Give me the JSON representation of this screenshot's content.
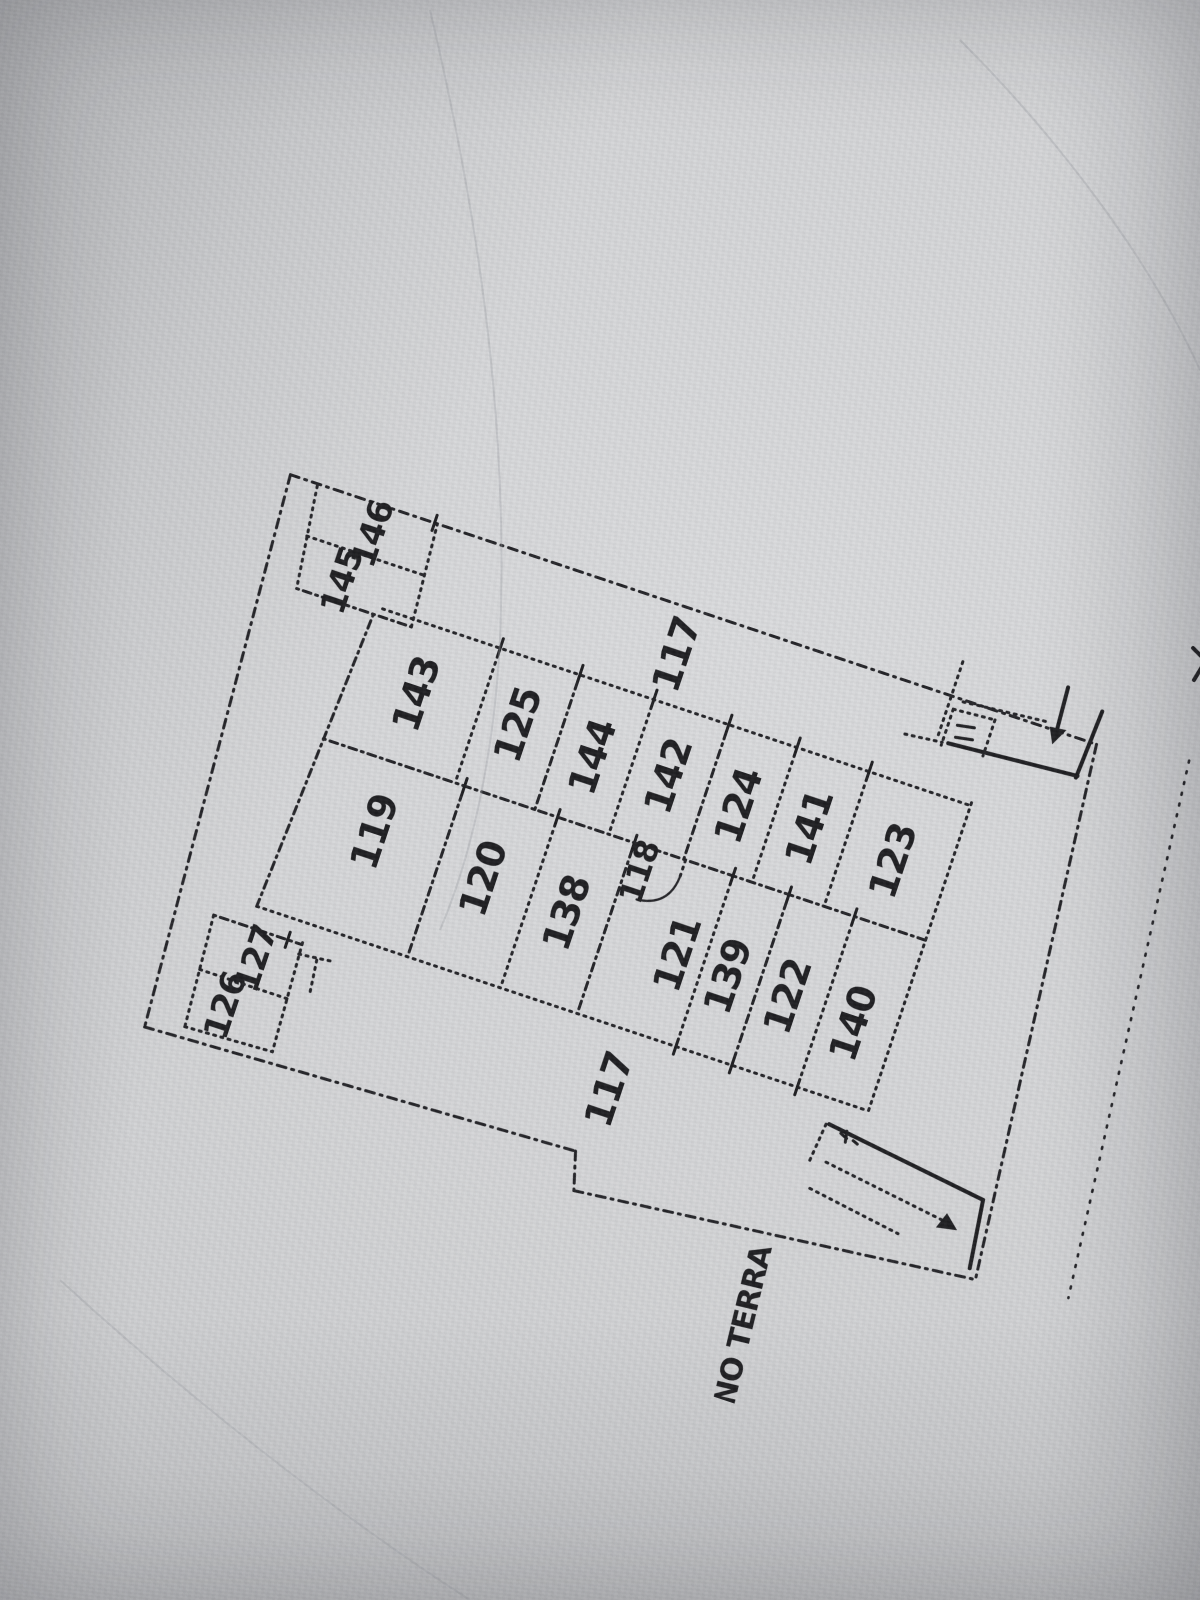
{
  "document": {
    "type": "cadastral floor plan photo",
    "title": "PIANO TERRA",
    "ink_color": "#1d1d20",
    "paper_color": "#d4d5d7"
  },
  "plan": {
    "title_label": "PIANO TERRA",
    "room_numbers": [
      "117",
      "118",
      "119",
      "120",
      "121",
      "122",
      "123",
      "124",
      "125",
      "126",
      "127",
      "138",
      "139",
      "140",
      "141",
      "142",
      "143",
      "144",
      "145",
      "146"
    ],
    "labels": [
      {
        "id": "room-146",
        "label": "146",
        "x": -8,
        "y": 30,
        "size": 34
      },
      {
        "id": "room-145",
        "label": "145",
        "x": -22,
        "y": 84,
        "size": 34
      },
      {
        "id": "corridor-117-top",
        "label": "117",
        "x": 318,
        "y": 48
      },
      {
        "id": "room-143",
        "label": "143",
        "x": 84,
        "y": 168
      },
      {
        "id": "room-125",
        "label": "125",
        "x": 190,
        "y": 165
      },
      {
        "id": "room-144",
        "label": "144",
        "x": 271,
        "y": 172
      },
      {
        "id": "room-142",
        "label": "142",
        "x": 349,
        "y": 166
      },
      {
        "id": "room-124",
        "label": "124",
        "x": 425,
        "y": 172
      },
      {
        "id": "room-141",
        "label": "141",
        "x": 499,
        "y": 170
      },
      {
        "id": "room-123",
        "label": "123",
        "x": 589,
        "y": 175
      },
      {
        "id": "room-119",
        "label": "119",
        "x": 88,
        "y": 312
      },
      {
        "id": "room-120",
        "label": "120",
        "x": 206,
        "y": 322
      },
      {
        "id": "room-138",
        "label": "138",
        "x": 296,
        "y": 328
      },
      {
        "id": "room-118",
        "label": "118",
        "x": 352,
        "y": 266,
        "size": 32
      },
      {
        "id": "room-121",
        "label": "121",
        "x": 414,
        "y": 332
      },
      {
        "id": "room-139",
        "label": "139",
        "x": 469,
        "y": 337
      },
      {
        "id": "room-122",
        "label": "122",
        "x": 532,
        "y": 337
      },
      {
        "id": "room-140",
        "label": "140",
        "x": 603,
        "y": 342
      },
      {
        "id": "room-127",
        "label": "127",
        "x": 16,
        "y": 470,
        "size": 34
      },
      {
        "id": "room-126",
        "label": "126",
        "x": 2,
        "y": 524,
        "size": 34
      },
      {
        "id": "corridor-117-bottom",
        "label": "117",
        "x": 392,
        "y": 482
      },
      {
        "id": "plan-title",
        "label": "PIANO TERRA",
        "x": 597,
        "y": 690,
        "size": 30,
        "rot": -95,
        "spacing": 2
      }
    ]
  }
}
